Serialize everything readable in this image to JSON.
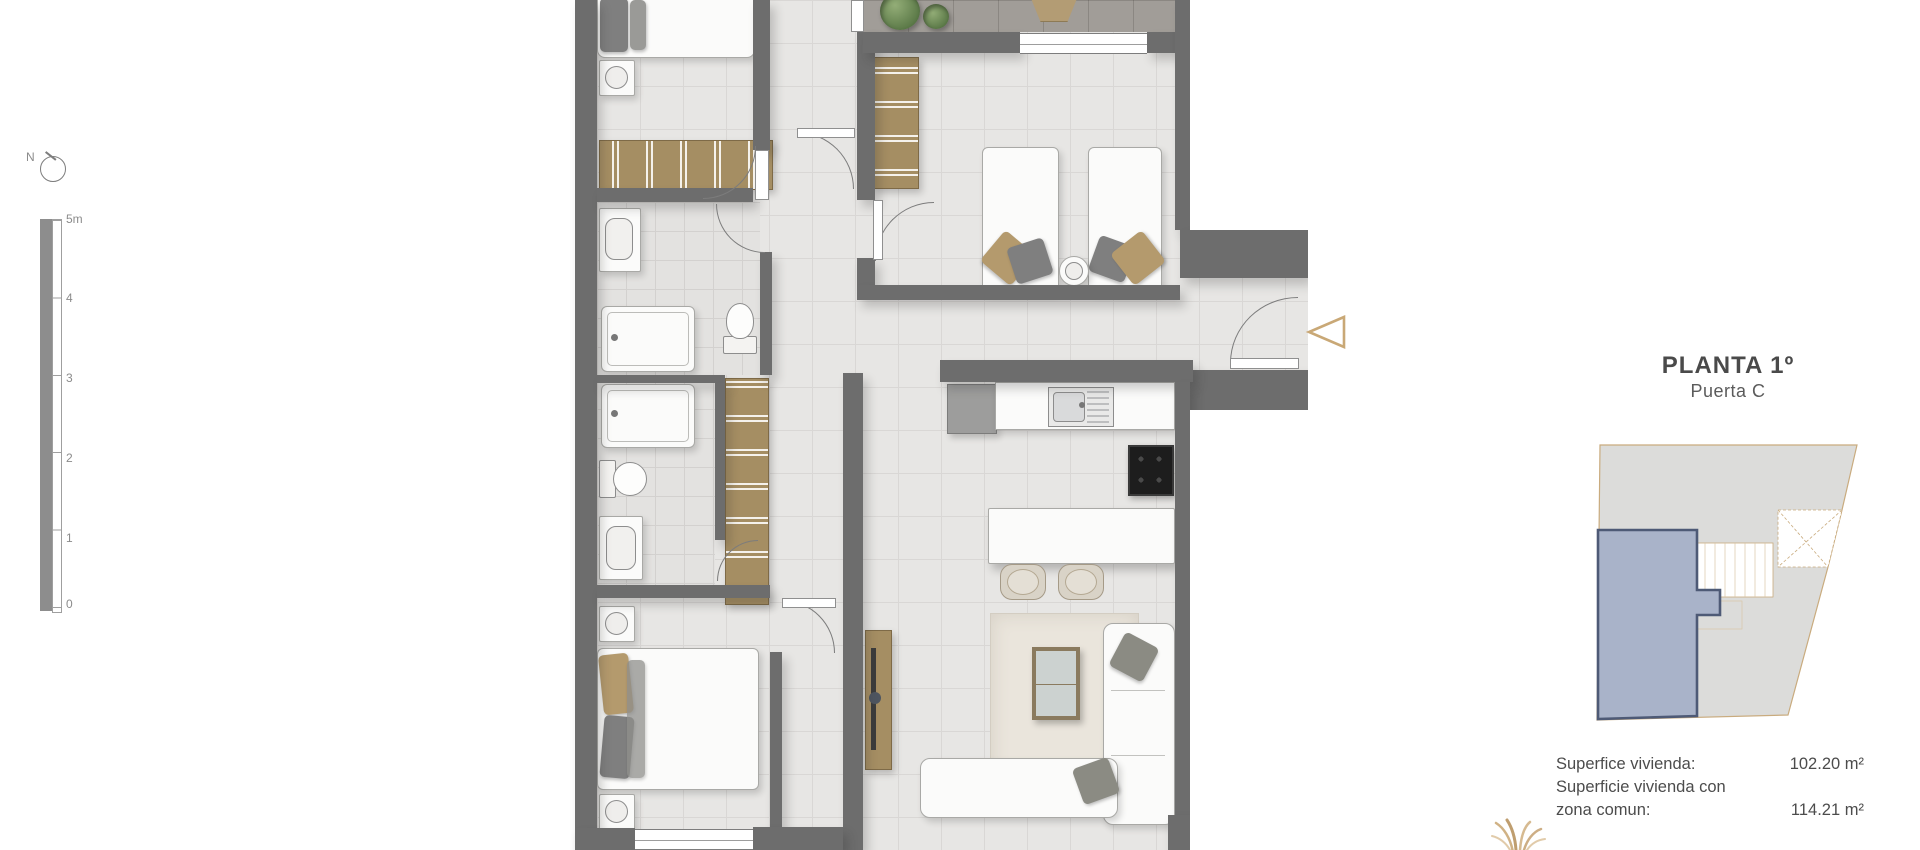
{
  "compass": {
    "label": "N"
  },
  "scale_bar": {
    "ticks": [
      "5m",
      "4",
      "3",
      "2",
      "1",
      "0"
    ],
    "unit": "meters",
    "range": [
      0,
      5
    ]
  },
  "panel": {
    "title": "PLANTA 1º",
    "subtitle": "Puerta C",
    "surfaces": [
      {
        "label": "Superfice vivienda:",
        "value": "102.20 m²"
      },
      {
        "label": "Superficie vivienda con",
        "value": ""
      },
      {
        "label": "zona comun:",
        "value": "114.21 m²"
      }
    ]
  },
  "key_plan": {
    "description": "building-footprint-with-highlighted-unit",
    "highlight_fill": "#a9b3c9",
    "highlight_stroke": "#4e5a76",
    "outline_color": "#c9ab7e"
  },
  "colors": {
    "wall": "#6d6d6d",
    "accent_gold": "#c9a876",
    "floor": "#e7e6e4",
    "closet_wood": "#a58e63",
    "terrace": "#a19d98"
  }
}
